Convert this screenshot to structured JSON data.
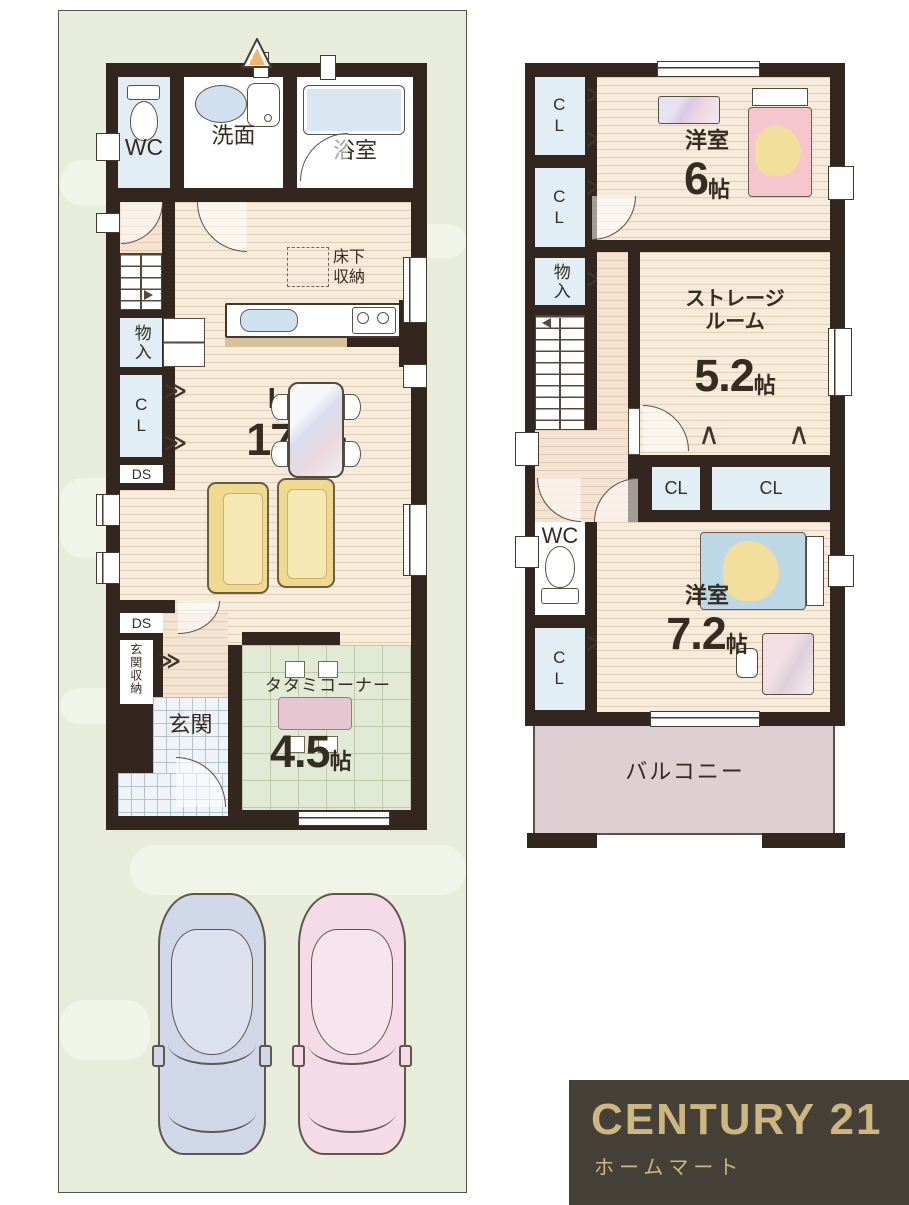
{
  "floor1": {
    "wc": "WC",
    "washroom": "洗面",
    "bath": "浴室",
    "underfloor_storage": "床下収納",
    "ldk": {
      "name": "LDK",
      "size": "17.2",
      "unit": "帖"
    },
    "mono_iri": "物入",
    "cl": "CL",
    "ds_upper": "DS",
    "ds_lower": "DS",
    "entrance_storage": "玄関収納",
    "entrance": "玄関",
    "tatami": {
      "name": "タタミコーナー",
      "size": "4.5",
      "unit": "帖"
    }
  },
  "floor2": {
    "cl_top1": "CL",
    "cl_top2": "CL",
    "mono_iri": "物入",
    "bedroom6": {
      "name": "洋室",
      "size": "6",
      "unit": "帖"
    },
    "storage_room": {
      "line1": "ストレージ",
      "line2": "ルーム",
      "size": "5.2",
      "unit": "帖"
    },
    "cl_mid_left": "CL",
    "cl_mid_right": "CL",
    "wc": "WC",
    "cl_lower": "CL",
    "bedroom72": {
      "name": "洋室",
      "size": "7.2",
      "unit": "帖"
    },
    "balcony": "バルコニー"
  },
  "icons": {
    "closet_folding_right": "≫",
    "closet_folding_up": "∧",
    "closet_folding_down": "∨"
  },
  "logo": {
    "brand": "CENTURY 21",
    "shop": "ホームマート"
  },
  "colors": {
    "wall": "#33261e",
    "wood_floor": "#f7ecdc",
    "tatami_floor": "#e0ead4",
    "closet_blue": "#e2eef6",
    "balcony_pink": "#decfd3",
    "background_green": "#e7ecdb",
    "logo_background": "#454038",
    "logo_gold": "#cdb77f",
    "car_blue": "#cfd7e9",
    "car_pink": "#f5dbe7"
  }
}
